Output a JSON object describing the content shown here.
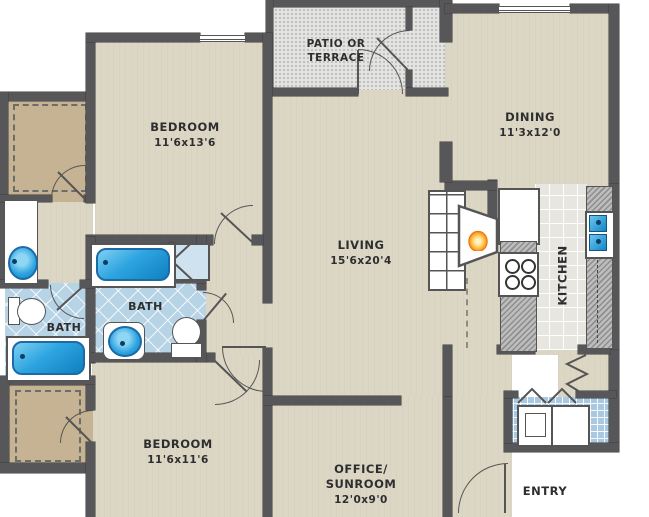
{
  "title": "Apartment floor plan",
  "rooms": {
    "patio": {
      "line1": "PATIO OR",
      "line2": "TERRACE"
    },
    "dining": {
      "name": "DINING",
      "dims": "11'3x12'0"
    },
    "bedroom1": {
      "name": "BEDROOM",
      "dims": "11'6x13'6"
    },
    "living": {
      "name": "LIVING",
      "dims": "15'6x20'4"
    },
    "kitchen": {
      "name": "KITCHEN"
    },
    "bath1": {
      "name": "BATH"
    },
    "bath2": {
      "name": "BATH"
    },
    "bedroom2": {
      "name": "BEDROOM",
      "dims": "11'6x11'6"
    },
    "office": {
      "line1": "OFFICE/",
      "line2": "SUNROOM",
      "dims": "12'0x9'0"
    },
    "entry": {
      "name": "ENTRY"
    }
  },
  "fixtures": [
    "bathtub",
    "bathtub",
    "toilet",
    "toilet",
    "vanity-sink",
    "pedestal-sink",
    "kitchen-double-sink",
    "refrigerator",
    "stove",
    "fireplace",
    "bookshelf",
    "linen-closet",
    "washer",
    "dryer",
    "walk-in-closet",
    "walk-in-closet",
    "pantry"
  ],
  "colors": {
    "wall": "#57575a",
    "floor_beige": "#dcd7c4",
    "closet_tan": "#c5b393",
    "bath_tile": "#b7d3e6",
    "laundry_tile": "#a9c9e2",
    "kitchen_tile": "#e7e6e1",
    "patio_speckle": "#e3e3e1",
    "fixture_blue": "#2da4e0",
    "counter_gray": "#a0a0a0",
    "flame_orange": "#ff9d2e"
  }
}
